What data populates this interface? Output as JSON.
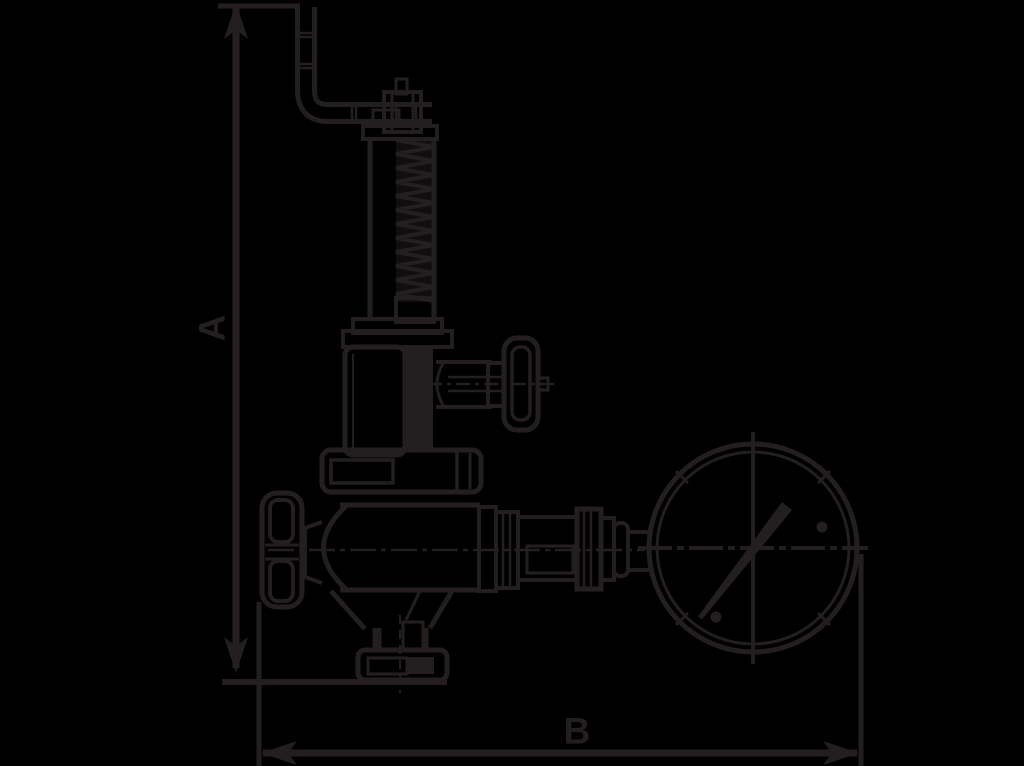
{
  "drawing": {
    "type": "technical-line-drawing",
    "subject": "safety relief valve with lift lever, handwheel, test connection and pressure gauge",
    "dimension_labels": {
      "vertical": "A",
      "horizontal": "B"
    },
    "colors": {
      "background": "#000000",
      "line": "#231F20"
    }
  }
}
